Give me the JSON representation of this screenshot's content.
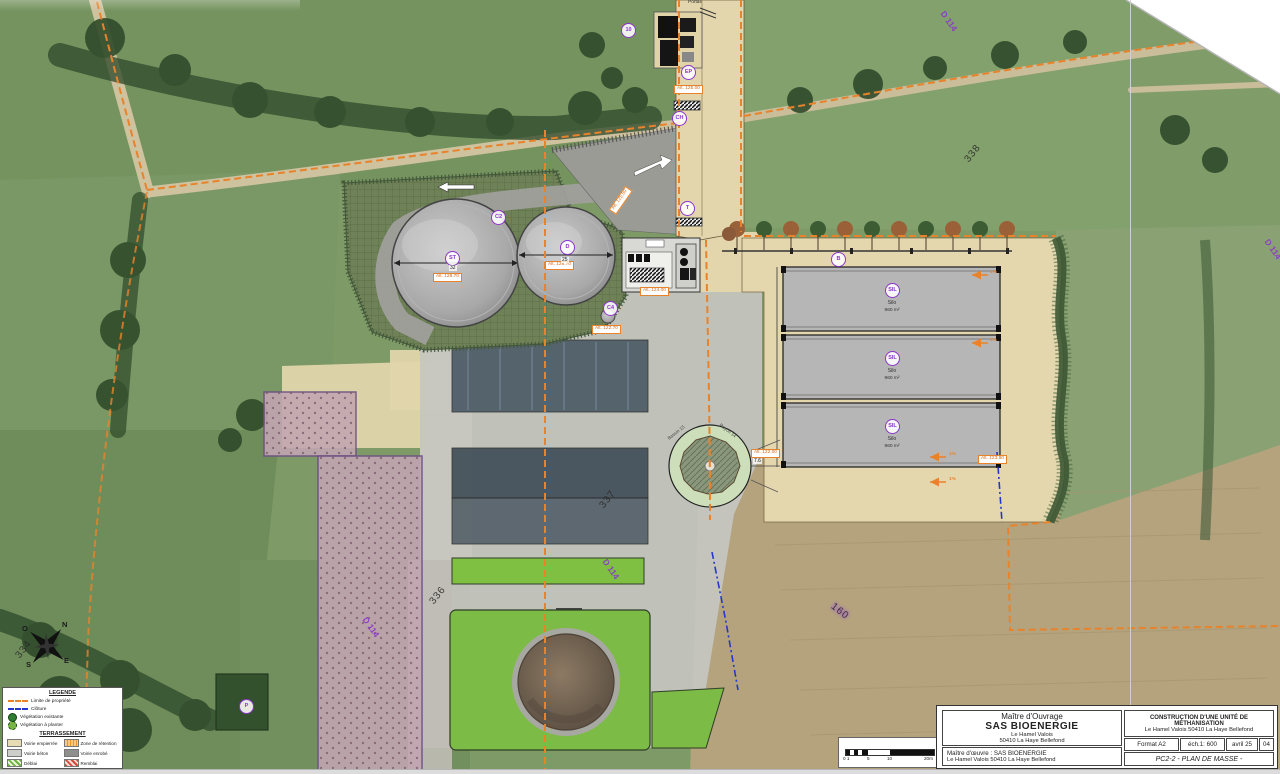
{
  "plan": {
    "portail": "Portail",
    "badges": [
      "EP",
      "CH",
      "10",
      "T",
      "C2",
      "ST",
      "D",
      "C4",
      "B",
      "SIL",
      "SIL",
      "SIL",
      "P"
    ],
    "alt_labels": [
      "Alt. 125.00",
      "Alt. 125.50",
      "Alt. 128.70",
      "Alt. 128.70",
      "Alt. 124.00",
      "Alt. 122.70",
      "Alt. 122.00",
      "Alt. 123.80"
    ],
    "dimensions": {
      "tank_large": "32",
      "tank_small": "25",
      "basin": "7.6"
    },
    "silos": [
      {
        "label": "Silo",
        "area": "960 m²"
      },
      {
        "label": "Silo",
        "area": "960 m²"
      },
      {
        "label": "Silo",
        "area": "960 m²"
      }
    ],
    "basin": {
      "left": "Bassin 15",
      "right": "Rayon 14"
    },
    "slopes": [
      "1%",
      "1%",
      "1%",
      "1%"
    ],
    "parcels": [
      "338",
      "337",
      "336",
      "334",
      "160"
    ],
    "road_refs": [
      "D 114",
      "D 114",
      "D 114",
      "D 114"
    ]
  },
  "compass": {
    "n": "N",
    "e": "E",
    "s": "S",
    "o": "O"
  },
  "legend": {
    "title": "LEGENDE",
    "items": [
      "Limite de propriété",
      "Clôture",
      "Végétation existante",
      "Végétation à planter"
    ],
    "terr_title": "TERRASSEMENT",
    "terr_items": [
      "Voirie empierrée",
      "Zone de rétention",
      "Voirie béton",
      "Voirie enrobé",
      "Déblai",
      "Remblai"
    ]
  },
  "scale_bar": {
    "ticks": [
      "0 1",
      "5",
      "10",
      "20m"
    ]
  },
  "title_block": {
    "owner_role": "Maître d'Ouvrage",
    "owner_name": "SAS BIOENERGIE",
    "owner_addr1": "Le Hamel Valois",
    "owner_addr2": "50410 La Haye Bellefond",
    "project_title": "CONSTRUCTION D'UNE UNITÉ DE MÉTHANISATION",
    "project_addr": "Le Hamel Valois   50410 La Haye Bellefond",
    "format_label": "Format  A2",
    "scale_label": "éch.1: 600",
    "date_label": "avril 25",
    "sheet_no": "04",
    "moe_line1": "Maître d'œuvre : SAS BIOENERGIE",
    "moe_line2": "Le Hamel Valois   50410 La Haye Bellefond",
    "doc_title": "PC2-2 - PLAN DE MASSE -"
  },
  "colors": {
    "property_line": "#e8832b",
    "fence_line": "#2438c8",
    "badge_purple": "#8b35cc"
  }
}
